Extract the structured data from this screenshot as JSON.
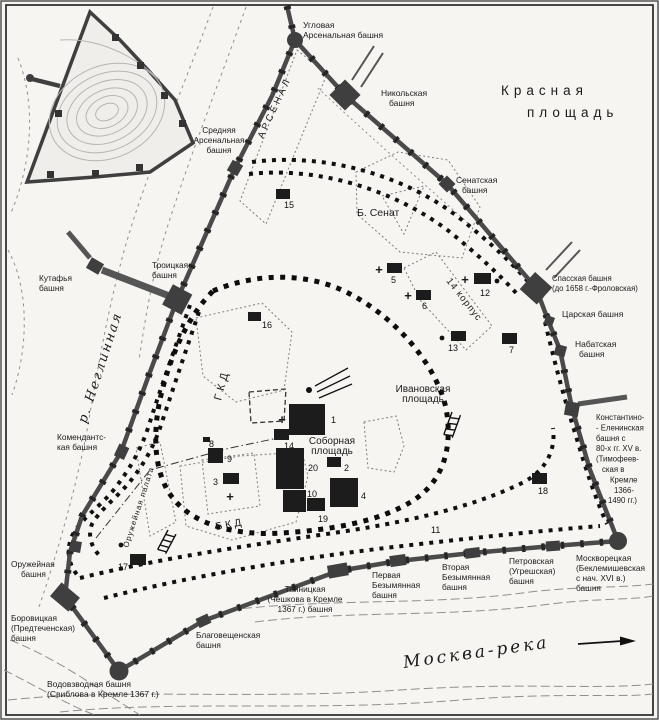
{
  "colors": {
    "paper": "#f6f5f2",
    "wall": "#4a4a4a",
    "old_wall": "#0d0d0d",
    "ink": "#1b1b1b",
    "river_line": "#8f8f8f",
    "site_marker": "#1c1c1c"
  },
  "place_labels": [
    {
      "id": "uglovaya-arsenalnaya",
      "lines": [
        "Угловая",
        "Арсенальная башня"
      ],
      "x": 303,
      "y": 28,
      "size": 8.5
    },
    {
      "id": "nikolskaya",
      "lines": [
        "Никольская",
        {
          "t": "башня",
          "dx": 8
        }
      ],
      "x": 381,
      "y": 96,
      "size": 8.5
    },
    {
      "id": "krasnaya-1",
      "lines": [
        "Красная"
      ],
      "x": 501,
      "y": 95,
      "size": 13.5,
      "spacing": 5
    },
    {
      "id": "krasnaya-2",
      "lines": [
        "площадь"
      ],
      "x": 527,
      "y": 117,
      "size": 13.5,
      "spacing": 5
    },
    {
      "id": "senatskaya",
      "lines": [
        "Сенатская",
        {
          "t": "башня",
          "dx": 6
        }
      ],
      "x": 456,
      "y": 183,
      "size": 8.5
    },
    {
      "id": "spasskaya",
      "lines": [
        "Спасская башня",
        "(до 1658 г.-Фроловская)"
      ],
      "x": 552,
      "y": 281,
      "size": 7.8
    },
    {
      "id": "tsarskaya",
      "lines": [
        "Царская башня"
      ],
      "x": 562,
      "y": 317,
      "size": 8.5
    },
    {
      "id": "nabatskaya",
      "lines": [
        "Набатская",
        {
          "t": "башня",
          "dx": 4
        }
      ],
      "x": 575,
      "y": 347,
      "size": 8.5
    },
    {
      "id": "konstantino-eleninskaya",
      "lines": [
        "Константино-",
        "- Еленинская",
        "башня с",
        "80-х гг. XV в.",
        "(Тимофеев-",
        {
          "t": "ская в",
          "dx": 6
        },
        {
          "t": "Кремле",
          "dx": 14
        },
        {
          "t": "1366-",
          "dx": 18
        },
        {
          "t": "1490 гг.)",
          "dx": 12
        }
      ],
      "x": 596,
      "y": 420,
      "size": 7.8,
      "lh": 10.4
    },
    {
      "id": "moskvoretskaya",
      "lines": [
        "Москворецкая",
        "(Беклемишевская",
        "с нач. XVI в.)",
        "башня"
      ],
      "x": 576,
      "y": 561,
      "size": 8.3
    },
    {
      "id": "petrovskaya",
      "lines": [
        "Петровская",
        "(Угрешская)",
        "башня"
      ],
      "x": 509,
      "y": 564,
      "size": 8.3
    },
    {
      "id": "vtoraya-bezymyannaya",
      "lines": [
        "Вторая",
        "Безымянная",
        "башня"
      ],
      "x": 442,
      "y": 570,
      "size": 8.3
    },
    {
      "id": "pervaya-bezymyannaya",
      "lines": [
        "Первая",
        "Безымянная",
        "башня"
      ],
      "x": 372,
      "y": 578,
      "size": 8.3
    },
    {
      "id": "tainitskaya",
      "lines": [
        "Тайницкая",
        "(Чешкова в Кремле",
        "1367 г.) башня"
      ],
      "x": 305,
      "y": 592,
      "size": 8.3,
      "anchor": "middle"
    },
    {
      "id": "blagoveshchenskaya",
      "lines": [
        "Благовещенская",
        "башня"
      ],
      "x": 196,
      "y": 638,
      "size": 8.3
    },
    {
      "id": "vodovzvodnaya",
      "lines": [
        "Водовзводная башня",
        "(Свиблова в Кремле 1367 г.)"
      ],
      "x": 47,
      "y": 687,
      "size": 8.5
    },
    {
      "id": "borovitskaya",
      "lines": [
        "Боровицкая",
        "(Предтеченская)",
        "башня"
      ],
      "x": 11,
      "y": 621,
      "size": 8.3
    },
    {
      "id": "oruzheinaya-bashnya",
      "lines": [
        "Оружейная",
        {
          "t": "башня",
          "dx": 10
        }
      ],
      "x": 11,
      "y": 567,
      "size": 8.3
    },
    {
      "id": "komendantskaya",
      "lines": [
        "Комендантс-",
        "кая башня"
      ],
      "x": 57,
      "y": 440,
      "size": 8.3
    },
    {
      "id": "kutafya",
      "lines": [
        "Кутафья",
        "башня"
      ],
      "x": 39,
      "y": 281,
      "size": 8.3
    },
    {
      "id": "troitskaya",
      "lines": [
        "Троицкая",
        "башня"
      ],
      "x": 152,
      "y": 268,
      "size": 8.3
    },
    {
      "id": "srednyaya-arsenalnaya",
      "lines": [
        "Средняя",
        "Арсенальная",
        "башня"
      ],
      "x": 219,
      "y": 133,
      "size": 8.3,
      "anchor": "middle"
    },
    {
      "id": "reka-neglinnaya",
      "lines": [
        "р. Неглинная"
      ],
      "x": 86,
      "y": 424,
      "rot": -72,
      "size": 13,
      "spacing": 2,
      "italic": true,
      "serif": true
    },
    {
      "id": "arsenal",
      "lines": [
        "АРСЕНАЛ"
      ],
      "x": 263,
      "y": 139,
      "rot": -65,
      "size": 9.5,
      "spacing": 3
    },
    {
      "id": "b-senat",
      "lines": [
        "Б. Сенат"
      ],
      "x": 357,
      "y": 216,
      "size": 10.5
    },
    {
      "id": "korpus-14",
      "lines": [
        "14 корпус"
      ],
      "x": 446,
      "y": 281,
      "rot": 52,
      "size": 9.5,
      "spacing": 1
    },
    {
      "id": "gkd",
      "lines": [
        "ГКД"
      ],
      "x": 221,
      "y": 401,
      "rot": -75,
      "size": 11,
      "spacing": 4
    },
    {
      "id": "bkd",
      "lines": [
        "БКД"
      ],
      "x": 216,
      "y": 530,
      "rot": -10,
      "size": 10.5,
      "spacing": 3
    },
    {
      "id": "oruzheinaya-palata",
      "lines": [
        "Оружейная палата"
      ],
      "x": 128,
      "y": 548,
      "rot": -72,
      "size": 7.8,
      "spacing": 1
    },
    {
      "id": "sobornaya-ploshchad",
      "lines": [
        "Соборная",
        "площадь"
      ],
      "x": 332,
      "y": 444,
      "size": 10,
      "anchor": "middle"
    },
    {
      "id": "ivanovskaya-ploshchad",
      "lines": [
        "Ивановская",
        "площадь"
      ],
      "x": 423,
      "y": 392,
      "size": 10,
      "anchor": "middle"
    },
    {
      "id": "moskva-reka",
      "lines": [
        "Москва-река"
      ],
      "x": 404,
      "y": 668,
      "rot": -8,
      "size": 17,
      "spacing": 3,
      "italic": true,
      "serif": true
    }
  ],
  "numbered_sites": [
    {
      "n": "1",
      "rect": [
        289,
        404,
        36,
        31
      ],
      "cross": [
        282,
        424
      ],
      "nx": 331,
      "ny": 423
    },
    {
      "n": "2",
      "rect": [
        327,
        457,
        14,
        10
      ],
      "nx": 344,
      "ny": 471
    },
    {
      "n": "3",
      "rect": [
        223,
        473,
        16,
        11
      ],
      "cross": [
        230,
        501
      ],
      "nx": 213,
      "ny": 485
    },
    {
      "n": "4",
      "rect": [
        330,
        478,
        28,
        29
      ],
      "nx": 361,
      "ny": 499
    },
    {
      "n": "5",
      "rect": [
        387,
        263,
        15,
        10
      ],
      "cross": [
        379,
        274
      ],
      "nx": 391,
      "ny": 283
    },
    {
      "n": "6",
      "rect": [
        416,
        290,
        15,
        10
      ],
      "cross": [
        408,
        300
      ],
      "nx": 422,
      "ny": 309
    },
    {
      "n": "7",
      "rect": [
        502,
        333,
        15,
        11
      ],
      "nx": 509,
      "ny": 353
    },
    {
      "n": "8",
      "rect": [
        203,
        437,
        7,
        5
      ],
      "nx": 209,
      "ny": 447
    },
    {
      "n": "9",
      "rect": [
        208,
        448,
        15,
        15
      ],
      "nx": 227,
      "ny": 462
    },
    {
      "n": "10",
      "rect": [
        283,
        490,
        23,
        22
      ],
      "nx": 307,
      "ny": 497
    },
    {
      "n": "11",
      "nx": 431,
      "ny": 533
    },
    {
      "n": "12",
      "rect": [
        474,
        273,
        17,
        11
      ],
      "cross": [
        465,
        284
      ],
      "dot": [
        497,
        281
      ],
      "nx": 480,
      "ny": 296
    },
    {
      "n": "13",
      "rect": [
        451,
        331,
        15,
        10
      ],
      "dot": [
        442,
        338
      ],
      "nx": 448,
      "ny": 351
    },
    {
      "n": "14",
      "rect": [
        274,
        429,
        15,
        11
      ],
      "nx": 284,
      "ny": 449
    },
    {
      "n": "15",
      "rect": [
        276,
        189,
        14,
        10
      ],
      "nx": 284,
      "ny": 208
    },
    {
      "n": "16",
      "rect": [
        248,
        312,
        13,
        9
      ],
      "nx": 262,
      "ny": 328
    },
    {
      "n": "17",
      "rect": [
        130,
        554,
        16,
        11
      ],
      "dot": [
        121,
        545
      ],
      "nx": 118,
      "ny": 570
    },
    {
      "n": "18",
      "rect": [
        532,
        473,
        15,
        11
      ],
      "nx": 538,
      "ny": 494
    },
    {
      "n": "19",
      "rect": [
        307,
        498,
        18,
        13
      ],
      "nx": 318,
      "ny": 522
    },
    {
      "n": "20",
      "rect": [
        276,
        448,
        28,
        41
      ],
      "nx": 308,
      "ny": 471
    }
  ],
  "flow_arrow": {
    "meaning": "river flow direction",
    "direction": "right"
  }
}
